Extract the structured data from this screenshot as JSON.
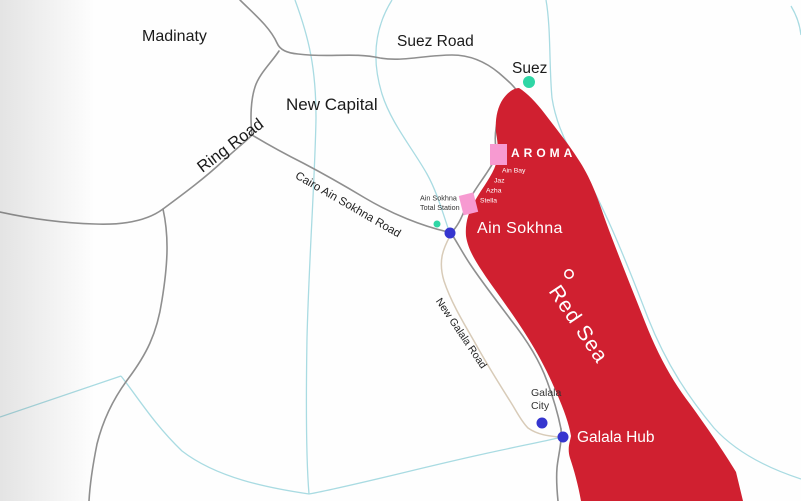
{
  "map_labels": {
    "madinaty": "Madinaty",
    "new_capital": "New Capital",
    "suez_road": "Suez Road",
    "suez": "Suez",
    "ring_road": "Ring Road",
    "cairo_ain_sokhna_road": "Cairo Ain Sokhna Road",
    "station_line1": "Ain Sokhna",
    "station_line2": "Total Station",
    "brand_logo": "AROMA",
    "resorts": [
      "Ain Bay",
      "Jaz",
      "Azha",
      "Stella"
    ],
    "ain_sokhna": "Ain Sokhna",
    "red_sea": "Red Sea",
    "new_galala_road": "New Galala Road",
    "galala_city_line1": "Galala",
    "galala_city_line2": "City",
    "galala_hub": "Galala Hub"
  },
  "colors": {
    "sea_red": "#d02030",
    "road_gray": "#8f8f8f",
    "road_beige": "#d8cbb8",
    "waterway_cyan": "#a9dbe2",
    "marker_blue": "#3535cf",
    "marker_teal": "#2fd6a5",
    "marker_pink": "#f79ad1",
    "ring_white": "#ffffff"
  }
}
